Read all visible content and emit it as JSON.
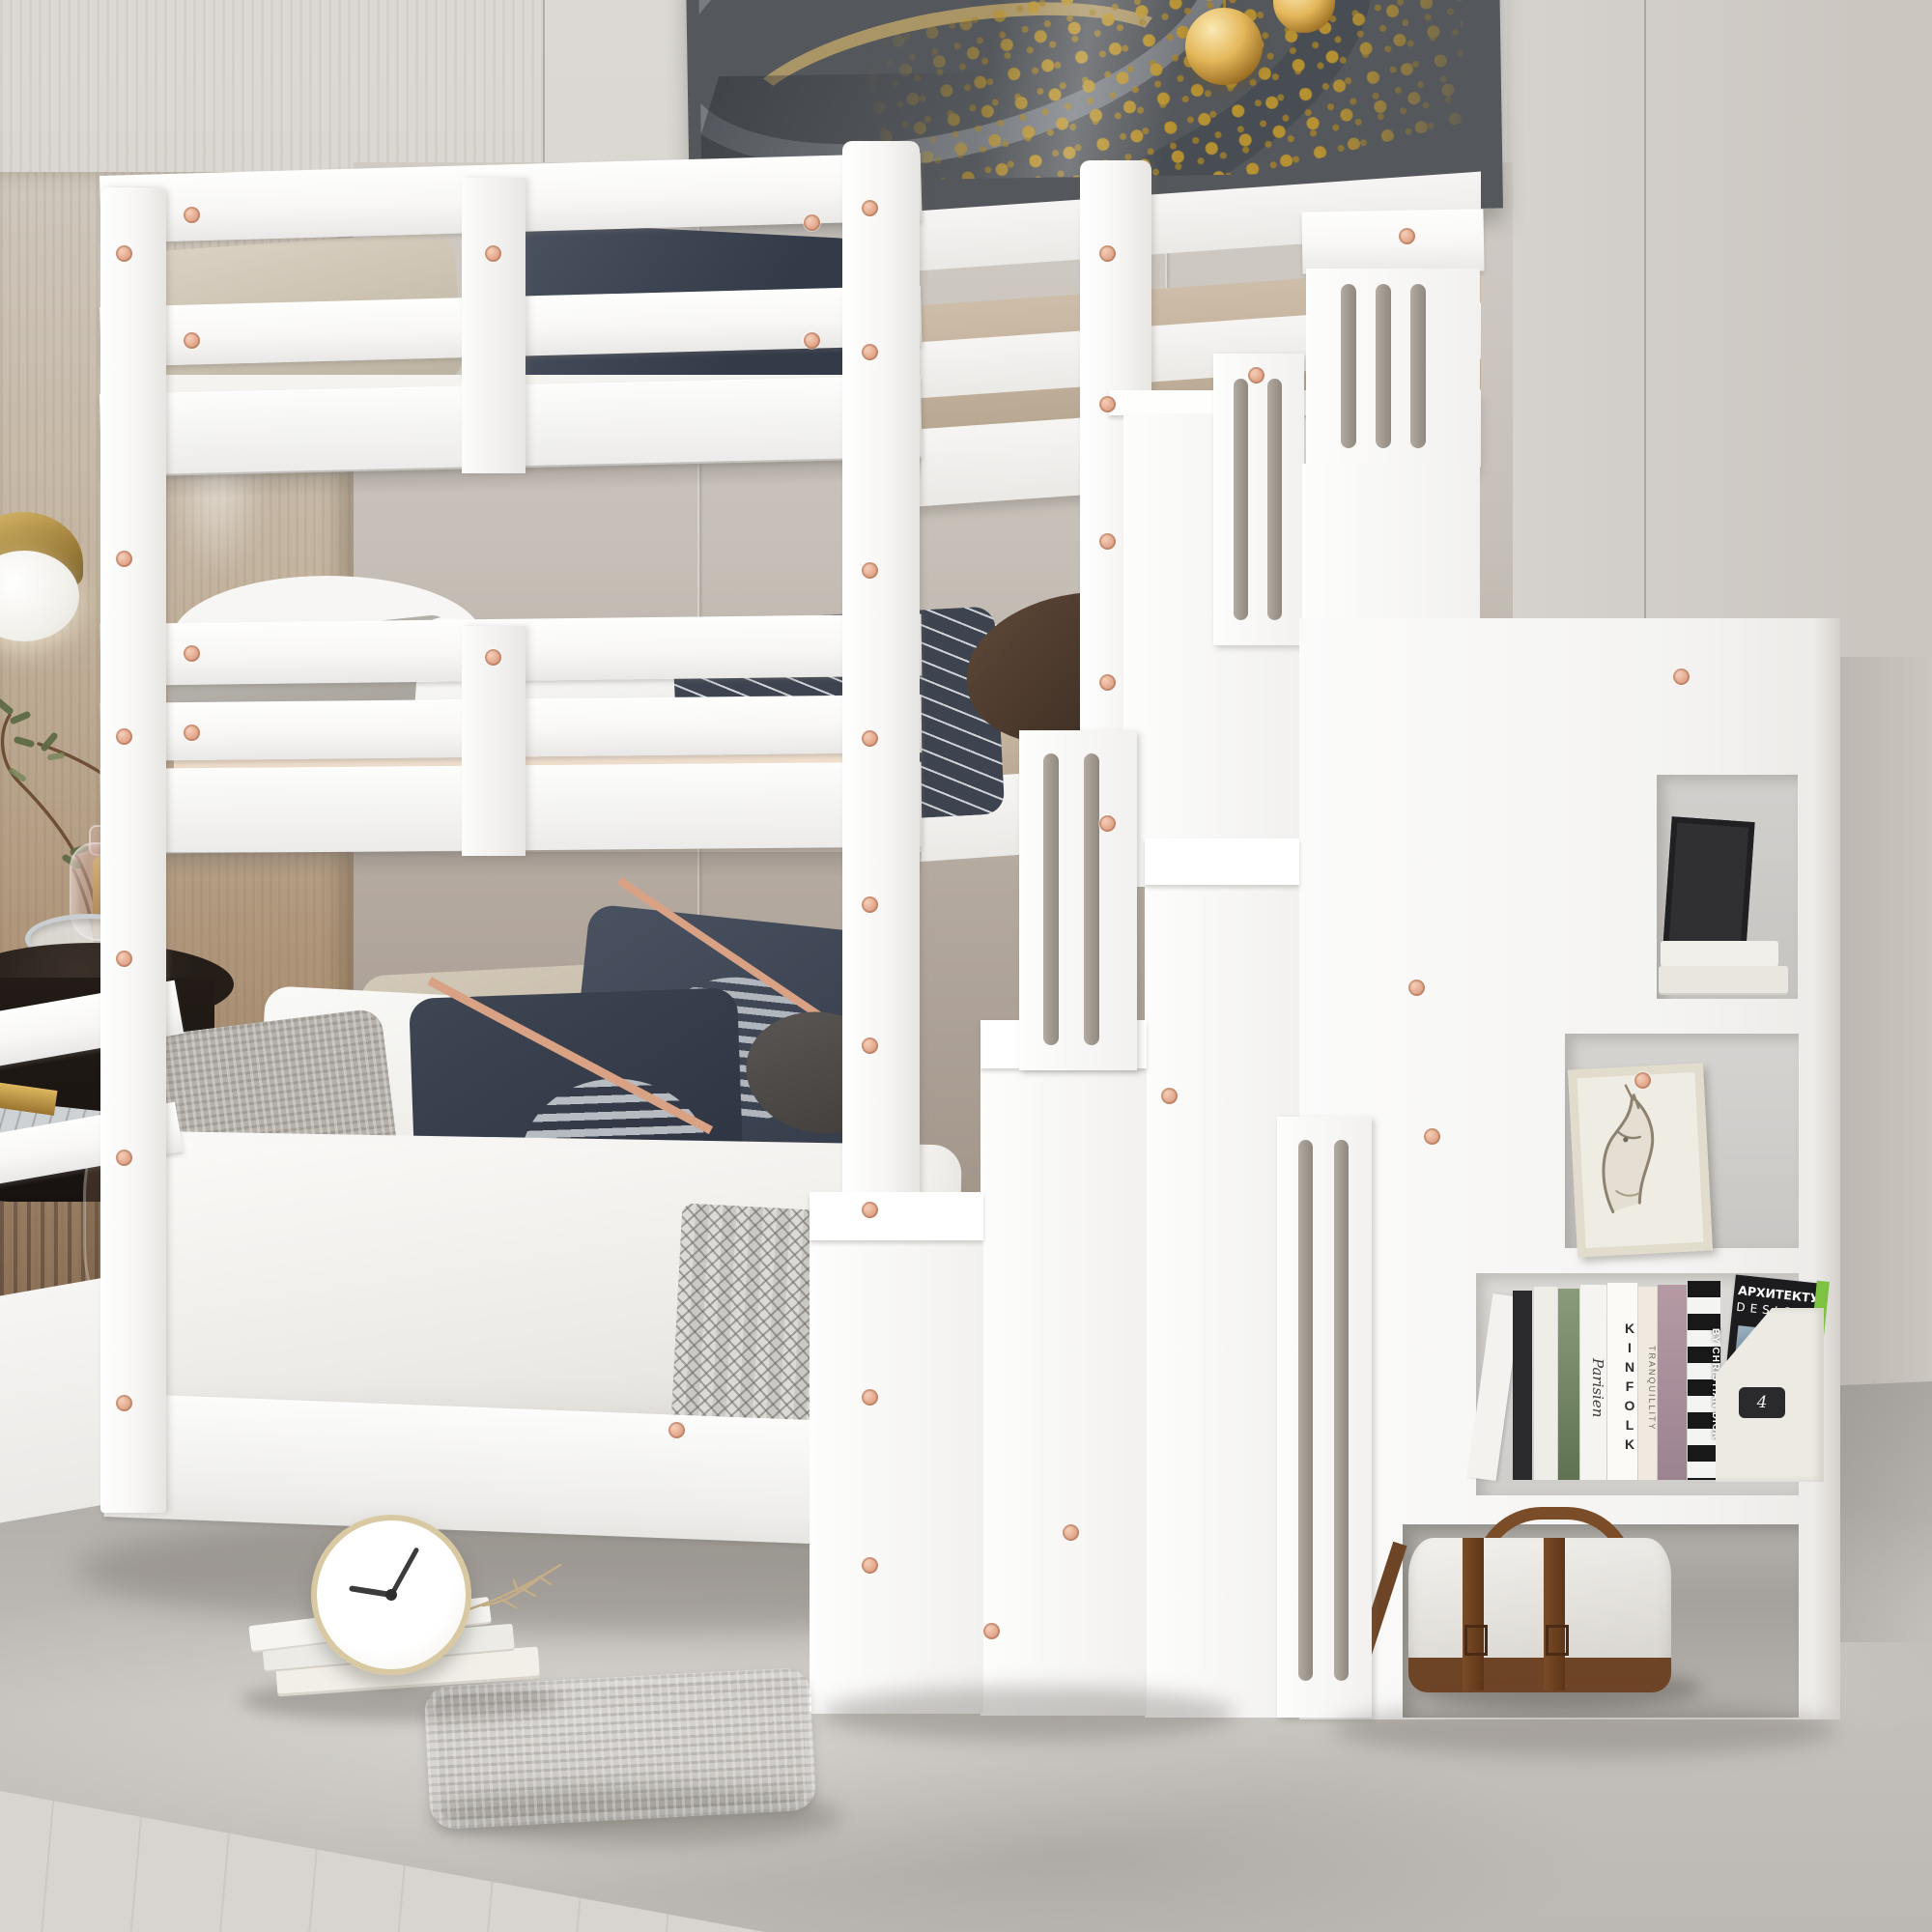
{
  "king_pillow": {
    "text": "KING"
  },
  "shelf_books": {
    "spine_script": "Parisien",
    "spine_kinfolk": "KINFOLK",
    "spine_tranquillity": "TRANQUILLITY",
    "spine_dior": "BY CHRISTIAN DIOR",
    "magazine_title": "АРХИТЕКТУРА",
    "magazine_subtitle": "DESIGN",
    "file_box_label": "4"
  },
  "clock": {
    "time_shown": "9:10"
  },
  "palette": {
    "wall": "#d7d3ce",
    "wood_wall": "#b69a7d",
    "dark_wainscot": "#5f4a36",
    "upholstery_panel": "#b2a79c",
    "bed_white": "#fbfbfa",
    "screw_rose_gold": "#e0a489",
    "sheet_blush": "#f0dfcd",
    "sheet_tan": "#c2b29e",
    "pillow_navy": "#3e4551",
    "pillow_brown": "#54402f",
    "rug_gray": "#b5b1ac",
    "floor_wood": "#eadfcf",
    "accent_gold": "#c49c44",
    "art_frame_gray": "#55585c",
    "duffel_strap_brown": "#6f4526",
    "file_box_green": "#7dc242"
  }
}
